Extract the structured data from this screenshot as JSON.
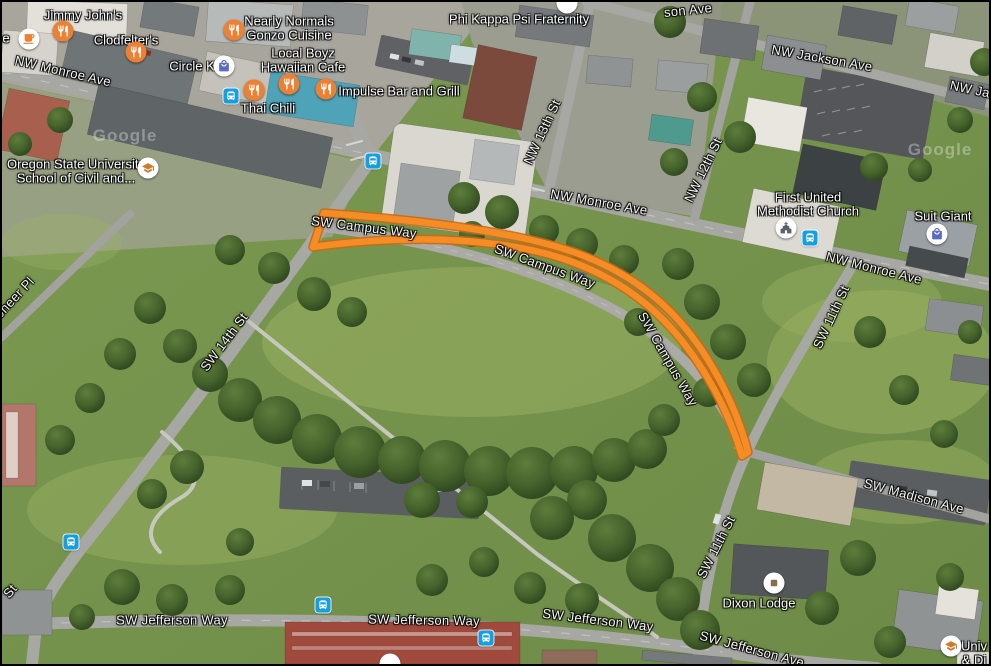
{
  "map": {
    "watermark": "Google"
  },
  "route": {
    "color": "#F07F1F",
    "description": "highlighted route outline along SW Campus Way"
  },
  "streets": [
    {
      "label": "NW Monroe Ave"
    },
    {
      "label": "NW Monroe Ave"
    },
    {
      "label": "NW Monroe Ave"
    },
    {
      "label": "NW Jackson Ave"
    },
    {
      "label": "NW Ja"
    },
    {
      "label": "son Ave"
    },
    {
      "label": "NW 13th St"
    },
    {
      "label": "NW 12th St"
    },
    {
      "label": "SW 11th St"
    },
    {
      "label": "SW 11th St"
    },
    {
      "label": "SW 14th St"
    },
    {
      "label": "Pioneer Pl"
    },
    {
      "label": "SW Campus Way"
    },
    {
      "label": "SW Campus Way"
    },
    {
      "label": "SW Campus Way"
    },
    {
      "label": "SW Madison Ave"
    },
    {
      "label": "SW Jefferson Way"
    },
    {
      "label": "SW Jefferson Way"
    },
    {
      "label": "SW Jefferson Way"
    },
    {
      "label": "SW Jefferson Ave"
    },
    {
      "label": "St"
    }
  ],
  "pois": [
    {
      "name": "Jimmy John's"
    },
    {
      "name": "e"
    },
    {
      "name": "Clodfelter's"
    },
    {
      "line1": "Nearly Normals",
      "line2": "Gonzo Cuisine"
    },
    {
      "line1": "Local Boyz",
      "line2": "Hawaiian Cafe"
    },
    {
      "name": "Circle K"
    },
    {
      "name": "Thai Chili"
    },
    {
      "name": "Impulse Bar and Grill"
    },
    {
      "name": "Phi Kappa Psi Fraternity"
    },
    {
      "line1": "Oregon State University",
      "line2": "School of Civil and..."
    },
    {
      "line1": "First United",
      "line2": "Methodist Church"
    },
    {
      "name": "Suit Giant"
    },
    {
      "name": "Dixon Lodge"
    },
    {
      "line1": "Univ",
      "line2": "& Di"
    }
  ]
}
